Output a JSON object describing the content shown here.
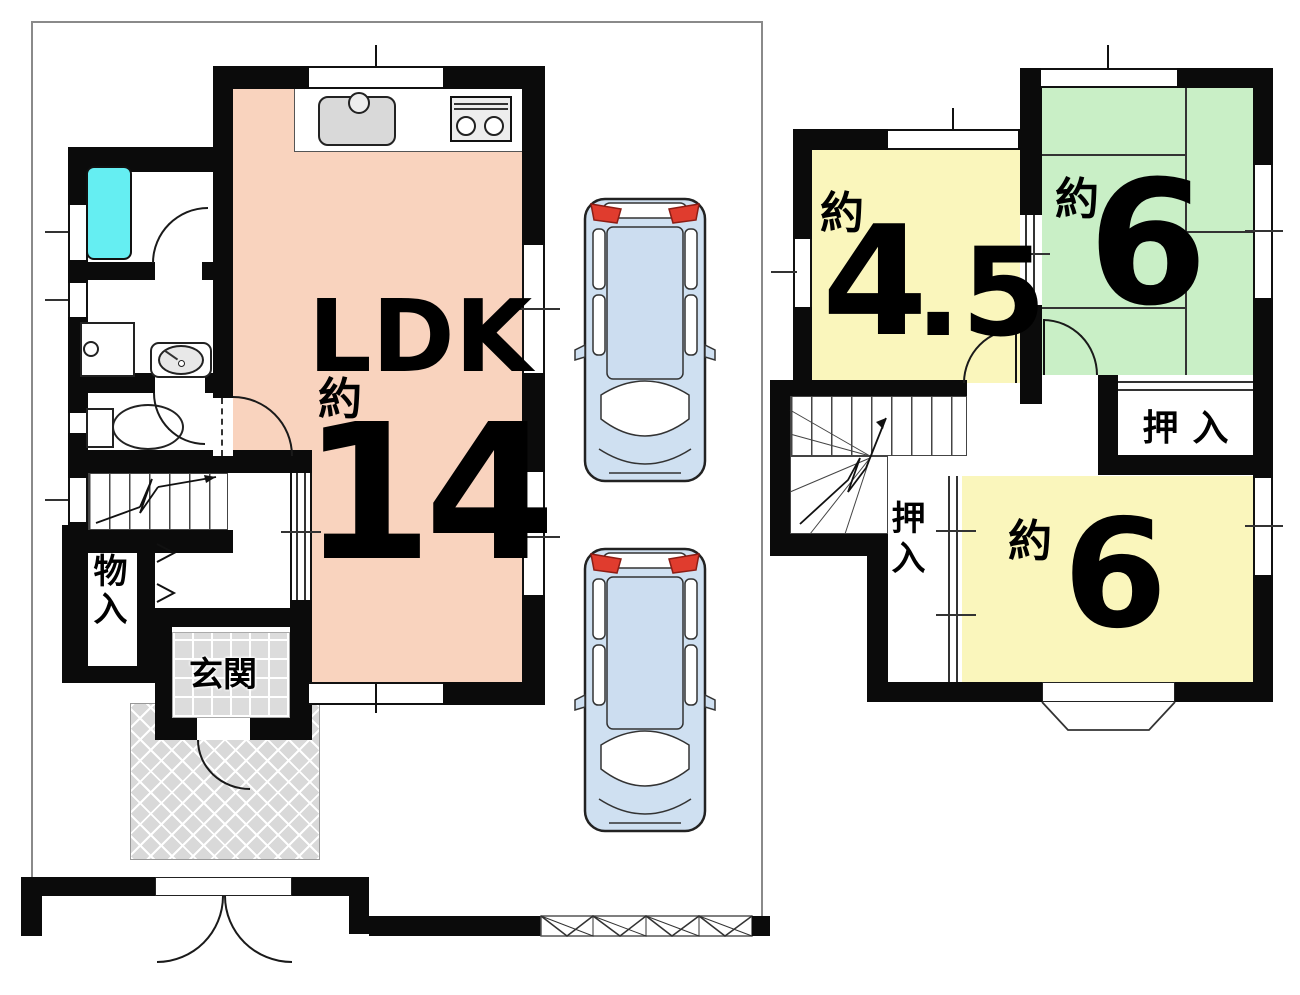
{
  "colors": {
    "wall": "#0b0b0b",
    "ldk_pink": "#f9d3be",
    "room_yellow": "#faf6bc",
    "room_green": "#c9efc6",
    "tub_cyan": "#65eef2",
    "tile_gray": "#dcdcdc",
    "porch_gray": "#d9d9d9",
    "car_body": "#cfe0f1",
    "car_glass": "#ccddf0",
    "car_taillight": "#e03c2e",
    "line": "#333333"
  },
  "floor1": {
    "ldk": {
      "name": "LDK",
      "approx": "約",
      "size": "14"
    },
    "genkan_label": "玄関",
    "monoiri_label": "物入"
  },
  "floor2": {
    "room45": {
      "approx": "約",
      "size_int": "4",
      "size_frac": ".5"
    },
    "room6_green": {
      "approx": "約",
      "size": "6"
    },
    "room6_yellow": {
      "approx": "約",
      "size": "6"
    },
    "oshiire_top_label": "押入",
    "oshiire_side_label": "押入"
  }
}
